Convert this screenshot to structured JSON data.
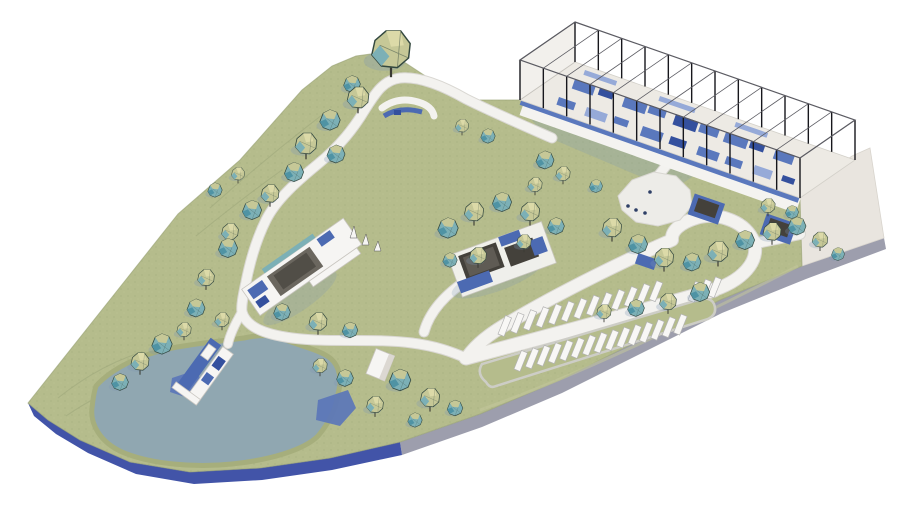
{
  "scene": {
    "type": "architectural-site-masterplan-3d-rendering",
    "elements": [
      "open-frame-pavilion",
      "entry-apron",
      "grass-field",
      "tree-clusters",
      "looping-footpath",
      "central-building-cluster",
      "marina-building",
      "lakeside-pier",
      "pond",
      "deep-water-inlets",
      "parking-lot",
      "drop-off-loop",
      "plaza",
      "boathouse",
      "hilltop-pavilion",
      "site-plinth"
    ],
    "palette": {
      "background": "#ffffff",
      "grass": "#b5bc8c",
      "grass_dark": "#9aa377",
      "shore": "#a6ae7c",
      "pond": "#90a7b1",
      "pond_deep": "#5b76b8",
      "path": "#f3f2ef",
      "path_edge": "#d9d7d2",
      "plaza": "#edece8",
      "slab_gray": "#9d9ead",
      "slab_blue": "#4254a8",
      "apron": "#e9e5df",
      "structure_floor": "#edeae4",
      "structure_blue": "#5a78bd",
      "structure_navy": "#34509e",
      "structure_blue_light": "#96aad8",
      "column": "#17171c",
      "frame": "#5b5b62",
      "roof_dark": "#6b675f",
      "roof_darker": "#44413b",
      "building_blue": "#4c6ab2",
      "building_white": "#f6f5f3",
      "tree_olive": "#c6c897",
      "tree_olive_light": "#dcdaa8",
      "tree_teal": "#7cb0b6",
      "tree_teal_dark": "#4f93a4",
      "tree_outline": "#33483f",
      "shadow": "#7d98b4",
      "stall_white": "#f8f7f5",
      "stall_edge": "#b3b3b3",
      "curb": "#cdcdc6"
    }
  },
  "pavilion": {
    "floor": [
      [
        575,
        62
      ],
      [
        855,
        160
      ],
      [
        800,
        198
      ],
      [
        520,
        100
      ]
    ],
    "height": 40,
    "bays": 12,
    "blocks": [
      {
        "x": 575,
        "y": 79,
        "w": 22,
        "h": 10,
        "c": "blue"
      },
      {
        "x": 600,
        "y": 88,
        "w": 15,
        "h": 7,
        "c": "navy"
      },
      {
        "x": 625,
        "y": 97,
        "w": 24,
        "h": 10,
        "c": "blue"
      },
      {
        "x": 650,
        "y": 105,
        "w": 18,
        "h": 8,
        "c": "blue"
      },
      {
        "x": 676,
        "y": 114,
        "w": 24,
        "h": 11,
        "c": "navy"
      },
      {
        "x": 701,
        "y": 123,
        "w": 20,
        "h": 9,
        "c": "blue"
      },
      {
        "x": 726,
        "y": 132,
        "w": 24,
        "h": 10,
        "c": "blue"
      },
      {
        "x": 751,
        "y": 141,
        "w": 15,
        "h": 7,
        "c": "navy"
      },
      {
        "x": 776,
        "y": 149,
        "w": 20,
        "h": 10,
        "c": "blue"
      },
      {
        "x": 559,
        "y": 97,
        "w": 18,
        "h": 8,
        "c": "blue"
      },
      {
        "x": 587,
        "y": 107,
        "w": 22,
        "h": 9,
        "c": "light"
      },
      {
        "x": 615,
        "y": 116,
        "w": 15,
        "h": 7,
        "c": "blue"
      },
      {
        "x": 643,
        "y": 126,
        "w": 22,
        "h": 10,
        "c": "blue"
      },
      {
        "x": 671,
        "y": 136,
        "w": 17,
        "h": 8,
        "c": "navy"
      },
      {
        "x": 699,
        "y": 146,
        "w": 22,
        "h": 9,
        "c": "blue"
      },
      {
        "x": 727,
        "y": 156,
        "w": 17,
        "h": 8,
        "c": "blue"
      },
      {
        "x": 755,
        "y": 165,
        "w": 19,
        "h": 9,
        "c": "light"
      },
      {
        "x": 783,
        "y": 175,
        "w": 13,
        "h": 6,
        "c": "navy"
      },
      {
        "x": 585,
        "y": 70,
        "w": 34,
        "h": 5,
        "c": "light"
      },
      {
        "x": 660,
        "y": 96,
        "w": 38,
        "h": 5,
        "c": "light"
      },
      {
        "x": 736,
        "y": 122,
        "w": 34,
        "h": 5,
        "c": "light"
      }
    ]
  },
  "parking": {
    "rows": [
      {
        "x": 498,
        "y": 334,
        "dx": 12.6,
        "dy": -2.9,
        "n": 13
      },
      {
        "x": 514,
        "y": 369,
        "dx": 11.4,
        "dy": -2.6,
        "n": 15
      },
      {
        "x": 688,
        "y": 300,
        "dx": 10.0,
        "dy": -2.3,
        "n": 3
      }
    ]
  },
  "trees": [
    [
      391,
      50,
      1.6,
      0
    ],
    [
      352,
      84,
      0.7,
      1
    ],
    [
      358,
      98,
      0.9,
      0
    ],
    [
      330,
      120,
      0.85,
      1
    ],
    [
      306,
      144,
      0.9,
      0
    ],
    [
      336,
      154,
      0.75,
      1
    ],
    [
      294,
      172,
      0.8,
      1
    ],
    [
      270,
      194,
      0.75,
      0
    ],
    [
      252,
      210,
      0.8,
      1
    ],
    [
      230,
      232,
      0.7,
      0
    ],
    [
      215,
      190,
      0.6,
      1
    ],
    [
      238,
      174,
      0.55,
      0
    ],
    [
      462,
      126,
      0.55,
      0
    ],
    [
      488,
      136,
      0.6,
      1
    ],
    [
      545,
      160,
      0.75,
      1
    ],
    [
      563,
      174,
      0.6,
      0
    ],
    [
      535,
      185,
      0.6,
      0
    ],
    [
      228,
      248,
      0.8,
      1
    ],
    [
      206,
      278,
      0.7,
      0
    ],
    [
      196,
      308,
      0.75,
      1
    ],
    [
      222,
      320,
      0.6,
      0
    ],
    [
      282,
      312,
      0.7,
      1
    ],
    [
      318,
      322,
      0.75,
      0
    ],
    [
      350,
      330,
      0.65,
      1
    ],
    [
      162,
      344,
      0.85,
      1
    ],
    [
      140,
      362,
      0.75,
      0
    ],
    [
      120,
      382,
      0.7,
      1
    ],
    [
      184,
      330,
      0.6,
      0
    ],
    [
      400,
      380,
      0.9,
      1
    ],
    [
      430,
      398,
      0.8,
      0
    ],
    [
      455,
      408,
      0.65,
      1
    ],
    [
      375,
      405,
      0.7,
      0
    ],
    [
      345,
      378,
      0.7,
      1
    ],
    [
      320,
      366,
      0.6,
      0
    ],
    [
      415,
      420,
      0.6,
      1
    ],
    [
      448,
      228,
      0.85,
      1
    ],
    [
      474,
      212,
      0.8,
      0
    ],
    [
      502,
      202,
      0.8,
      1
    ],
    [
      530,
      212,
      0.8,
      0
    ],
    [
      556,
      226,
      0.7,
      1
    ],
    [
      478,
      256,
      0.7,
      0
    ],
    [
      450,
      260,
      0.6,
      1
    ],
    [
      524,
      242,
      0.6,
      0
    ],
    [
      612,
      228,
      0.8,
      0
    ],
    [
      638,
      244,
      0.8,
      1
    ],
    [
      664,
      258,
      0.8,
      0
    ],
    [
      692,
      262,
      0.75,
      1
    ],
    [
      718,
      252,
      0.85,
      0
    ],
    [
      745,
      240,
      0.8,
      1
    ],
    [
      772,
      232,
      0.75,
      0
    ],
    [
      797,
      226,
      0.75,
      1
    ],
    [
      820,
      240,
      0.65,
      0
    ],
    [
      838,
      254,
      0.55,
      1
    ],
    [
      700,
      292,
      0.8,
      1
    ],
    [
      668,
      302,
      0.7,
      0
    ],
    [
      636,
      308,
      0.7,
      1
    ],
    [
      604,
      312,
      0.6,
      0
    ],
    [
      768,
      206,
      0.6,
      0
    ],
    [
      792,
      212,
      0.55,
      1
    ],
    [
      596,
      186,
      0.55,
      1
    ]
  ],
  "figures": [
    [
      628,
      206
    ],
    [
      636,
      210
    ],
    [
      645,
      213
    ],
    [
      650,
      192
    ]
  ]
}
